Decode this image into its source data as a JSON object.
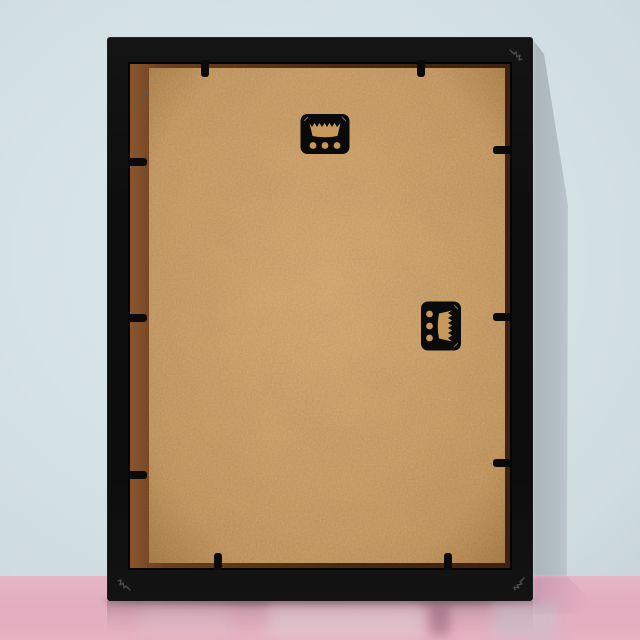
{
  "scene": {
    "description": "Back view of a black rectangular picture frame leaning against a pale blue wall on a glossy pink floor; tan MDF backing board held by black retaining clips, with two black sawtooth hangers (one horizontal near the top, one vertical at the right side) and metal staples at the corners.",
    "colors": {
      "wall": "#d5e2e6",
      "wall_highlight": "#dce8ea",
      "wall_edge": "#c7d3d9",
      "wall_shadow": "#a9b5b9",
      "floor": "#e2aebf",
      "floor_far": "#e7b6c6",
      "floor_shadow": "#cb9ab0",
      "frame": "#0e0e0e",
      "frame_seam": "#040404",
      "recess_light": "#8a552d",
      "recess_dark": "#3c2210",
      "board": "#cc9a5e",
      "board_light": "#d6a668",
      "board_dark": "#bd8a50",
      "hardware": "#0a0a0a",
      "staple": "#5a5a5a"
    },
    "hardware": {
      "hanger_count": 2,
      "top_hanger": "sawtooth-hanger-horizontal",
      "side_hanger": "sawtooth-hanger-vertical",
      "retaining_clip_count": 10,
      "corner_staple_count": 4
    }
  }
}
